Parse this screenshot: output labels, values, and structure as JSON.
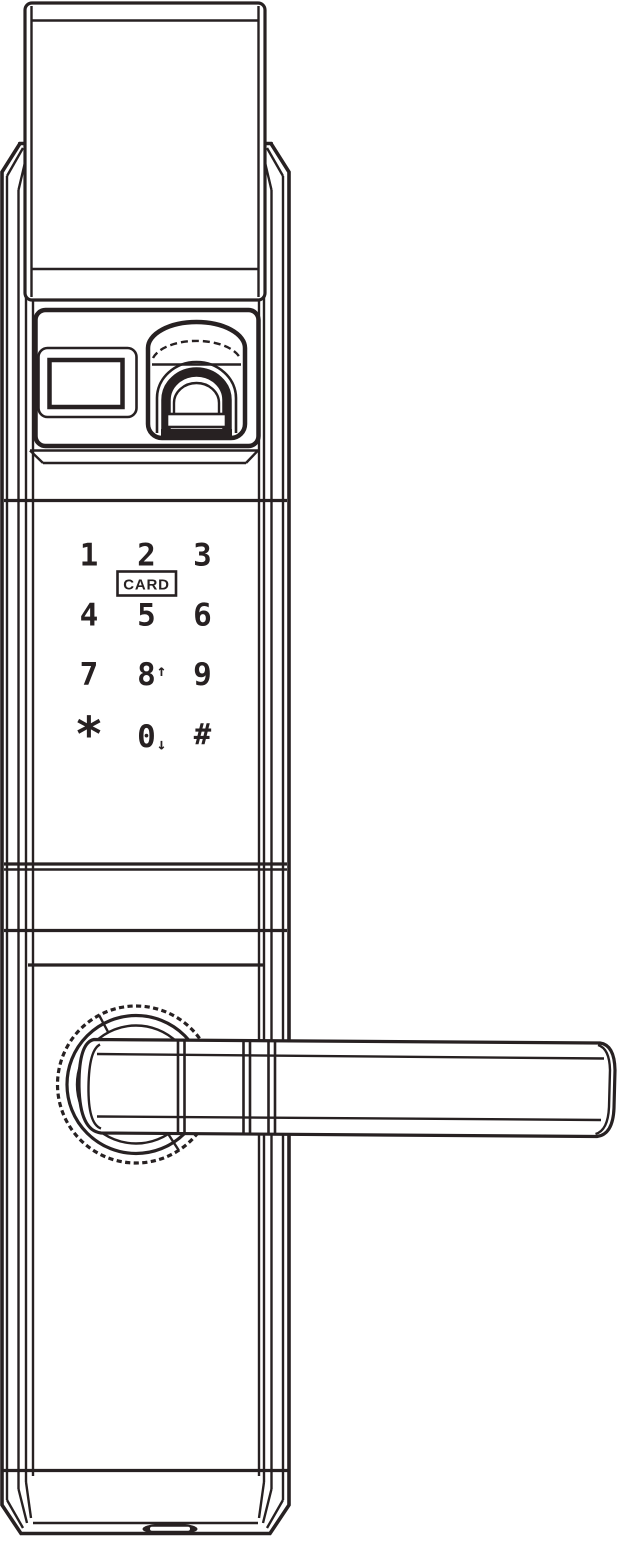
{
  "colors": {
    "ink": "#272122",
    "background": "#ffffff"
  },
  "keypad": {
    "keys": [
      {
        "label": "1"
      },
      {
        "label": "2"
      },
      {
        "label": "3"
      },
      {
        "label": "4"
      },
      {
        "label": "5"
      },
      {
        "label": "6"
      },
      {
        "label": "7"
      },
      {
        "label": "8"
      },
      {
        "label": "9"
      },
      {
        "label": "*"
      },
      {
        "label": "0"
      },
      {
        "label": "#"
      }
    ],
    "card_label": "CARD",
    "up_arrow": "↑",
    "down_arrow": "↓"
  }
}
